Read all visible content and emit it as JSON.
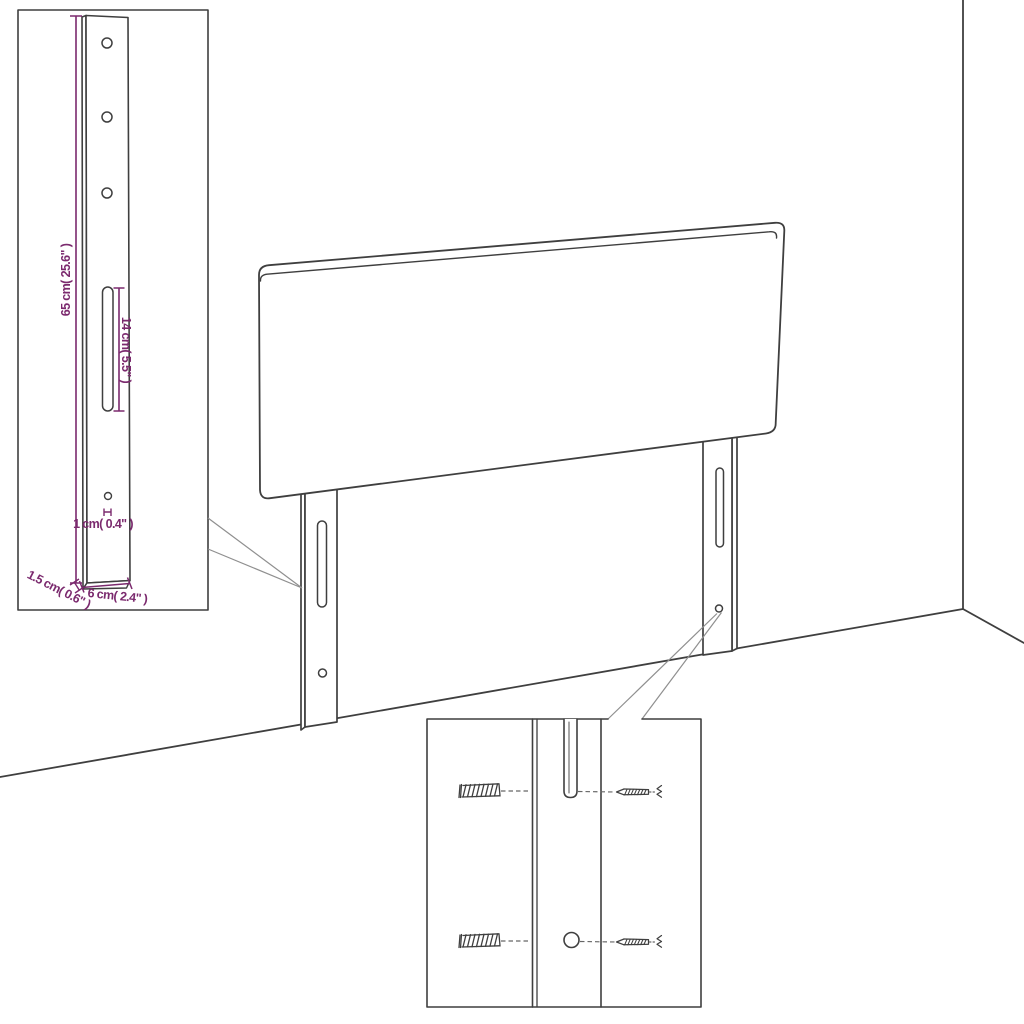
{
  "diagram": {
    "title": "headboard-assembly-diagram",
    "colors": {
      "ink": "#3f3f3f",
      "dimension": "#7b2a6e",
      "background": "#ffffff"
    },
    "bracket_inset": {
      "labels": {
        "height": "65 cm( 25.6\" )",
        "slot_length": "14 cm( 5.5\" )",
        "hole_diameter": "1 cm( 0.4\" )",
        "width": "6 cm( 2.4\" )",
        "thickness": "1.5 cm( 0.6\" )"
      }
    },
    "hardware_inset": {
      "parts": {
        "left": "wall-plug",
        "right": "screw"
      }
    }
  }
}
